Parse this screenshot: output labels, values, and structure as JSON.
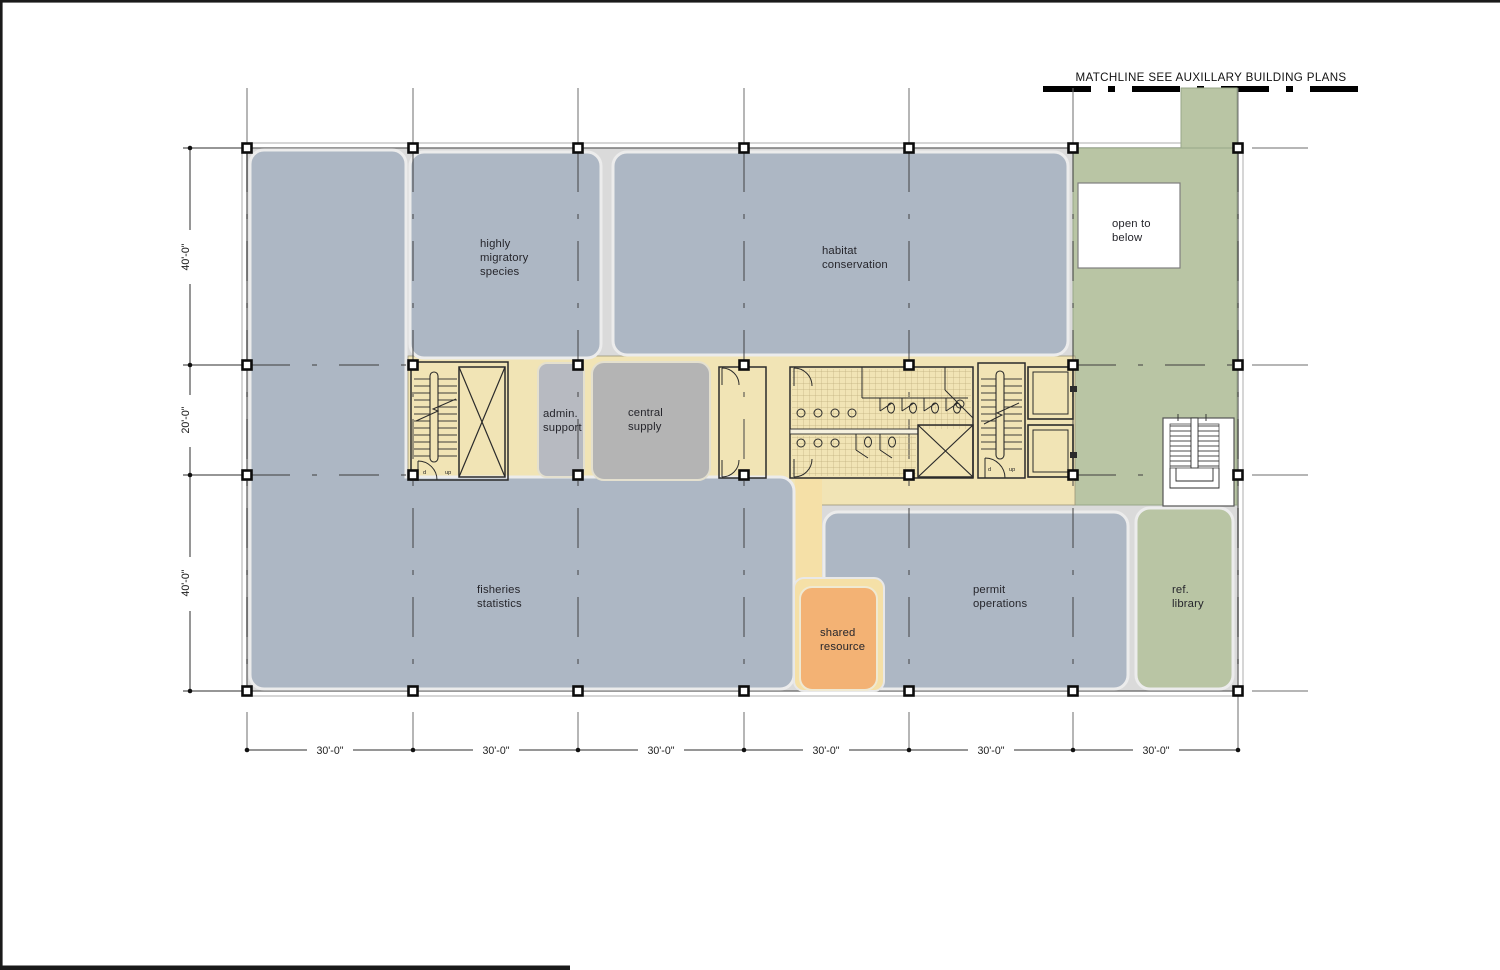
{
  "drawing": {
    "matchline_note": "MATCHLINE  SEE AUXILLARY BUILDING PLANS"
  },
  "rooms": {
    "highly_migratory": {
      "lines": [
        "highly",
        "migratory",
        "species"
      ]
    },
    "habitat_conservation": {
      "lines": [
        "habitat",
        "conservation"
      ]
    },
    "admin_support": {
      "lines": [
        "admin.",
        "support"
      ]
    },
    "central_supply": {
      "lines": [
        "central",
        "supply"
      ]
    },
    "fisheries_statistics": {
      "lines": [
        "fisheries",
        "statistics"
      ]
    },
    "permit_operations": {
      "lines": [
        "permit",
        "operations"
      ]
    },
    "shared_resource": {
      "lines": [
        "shared",
        "resource"
      ]
    },
    "ref_library": {
      "lines": [
        "ref.",
        "library"
      ]
    },
    "open_to_below": {
      "lines": [
        "open to",
        "below"
      ]
    }
  },
  "dimensions": {
    "left": [
      "40'-0\"",
      "20'-0\"",
      "40'-0\""
    ],
    "bottom": [
      "30'-0\"",
      "30'-0\"",
      "30'-0\"",
      "30'-0\"",
      "30'-0\"",
      "30'-0\""
    ]
  },
  "stairs": {
    "down_label": "d",
    "up_label": "up"
  },
  "colors": {
    "room_blue": "#adb7c4",
    "zone_green": "#b9c5a4",
    "core_yellow": "#f1e4b5",
    "corridor_yellow": "#f5e0a7",
    "shared_orange": "#f3b274",
    "supply_gray": "#b4b4b4",
    "admin_gray": "#b7bac1",
    "slab_gray": "#dadada",
    "open_white": "#ffffff"
  }
}
